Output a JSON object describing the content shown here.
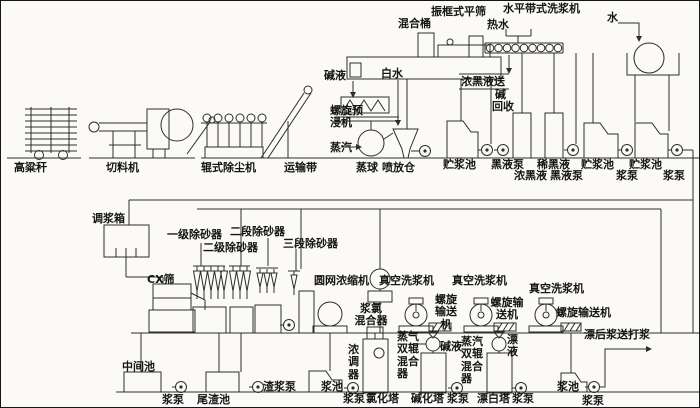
{
  "colors": {
    "ink": "#2d2d2d",
    "paper": "#fbfaf6"
  },
  "labels": {
    "top": {
      "zhenkuangshi": "振框式平筛",
      "hunhetong": "混合桶",
      "shuiping": "水平带式洗浆机",
      "reshui": "热水",
      "shui": "水",
      "jianye_top": "碱液",
      "baishui": "白水",
      "nongheiye_song": "浓黑液送",
      "jian": "碱",
      "huishou": "回收",
      "luoxuan_yujinji": "螺旋预\n浸机",
      "zhengqi_qiu": "蒸汽"
    },
    "row1": {
      "gaoliang": "高粱秆",
      "qieliaoji": "切料机",
      "gunshi": "辊式除尘机",
      "yunshudai": "运输带",
      "zhengqiu": "蒸球",
      "penfangcang": "喷放仓",
      "zhujiangchi1": "贮浆池",
      "heiyebeng1": "黑液泵",
      "nongheiye": "浓黑液",
      "xiheiye": "稀黑液",
      "heiyebeng2": "黑液泵",
      "zhujiangchi2": "贮浆池",
      "jiangbeng1": "浆泵",
      "zhujiangchi3": "贮浆池",
      "jiangbeng2": "浆泵"
    },
    "mid": {
      "tiaojiangxiang": "调浆箱",
      "yiji": "一级除砂器",
      "erduan": "二段除砂器",
      "erji": "二级除砂器",
      "sanduan": "三段除砂器",
      "cx": "CX筛",
      "yuanwang": "圆网浓缩机",
      "zhenkong1": "真空洗浆机",
      "zhenkong2": "真空洗浆机",
      "zhenkong3": "真空洗浆机",
      "jianglv": "浆氯\n混合器",
      "luoxuanshusong1": "螺旋\n输送\n机",
      "luoxuanshusong2": "螺旋输\n送机",
      "luoxuanshusong3": "螺旋输送机",
      "zhengqishuanggun1": "蒸气\n双辊\n混合\n器",
      "jianye_mid": "碱液",
      "zhengqishuanggun2": "蒸汽\n双辊\n混合\n器",
      "piaoye": "漂\n液",
      "piaohou": "漂后浆送打浆"
    },
    "bottom": {
      "zhongjianchi": "中间池",
      "jiangbeng3": "浆泵",
      "weizhachi": "尾渣池",
      "zhajiangbeng": "渣浆泵",
      "jiangchi1": "浆池",
      "nongtiaoqi": "浓\n调\n器",
      "jiangbeng4": "浆泵",
      "lvhuata": "氯化塔",
      "jianhuata": "碱化塔",
      "jiangbeng5": "浆泵",
      "piaobaita": "漂白塔",
      "jiangbeng6": "浆泵",
      "jiangchi2": "浆池",
      "jiangbeng7": "浆泵"
    }
  }
}
